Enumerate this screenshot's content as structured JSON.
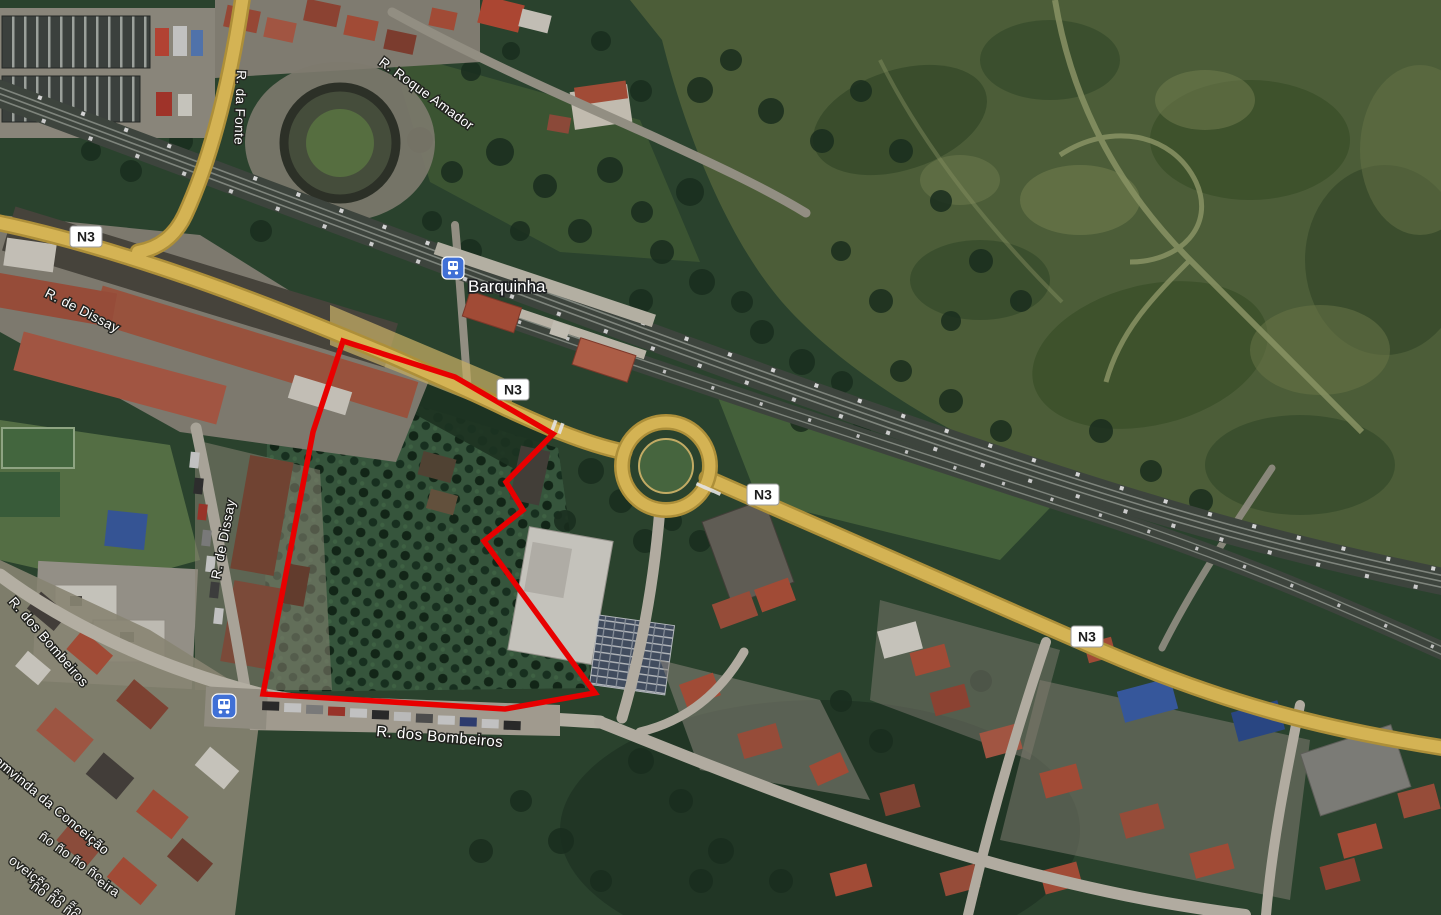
{
  "map": {
    "station": {
      "label": "Barquinha"
    },
    "road_shield_label": "N3",
    "streets": {
      "fonte": "R. da Fonte",
      "roque_amador": "R. Roque Amador",
      "dissay": "R. de Dissay",
      "bombeiros": "R. dos Bombeiros",
      "conceicao": "Bemvinda da Conceição",
      "garbled_1": "ño ño ño ño",
      "garbled_2": "oveiçño ño ño",
      "garbled_3": "eira"
    },
    "icons": {
      "station_marker": "train-icon",
      "bus_stop_marker": "bus-icon"
    },
    "colors": {
      "parcel_outline": "#e80000",
      "road_yellow": "#eec95f",
      "road_casing": "#c2a040",
      "transit_blue": "#4070d6",
      "shield_bg": "#ffffff"
    },
    "parcel": {
      "vertices": [
        [
          343,
          341
        ],
        [
          455,
          377
        ],
        [
          553,
          434
        ],
        [
          506,
          482
        ],
        [
          523,
          510
        ],
        [
          484,
          541
        ],
        [
          595,
          693
        ],
        [
          505,
          709
        ],
        [
          263,
          694
        ],
        [
          313,
          432
        ]
      ]
    }
  }
}
